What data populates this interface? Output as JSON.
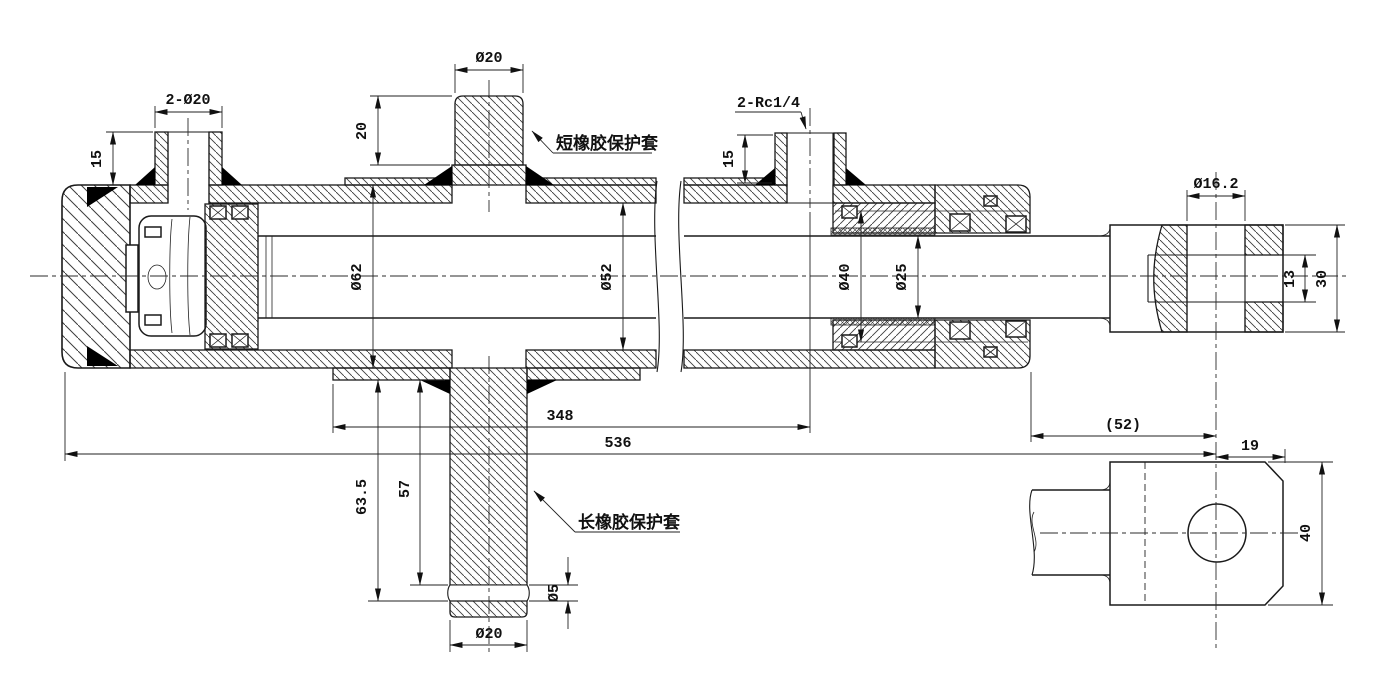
{
  "drawing": {
    "annotations": {
      "short_sleeve": "短橡胶保护套",
      "long_sleeve": "长橡胶保护套"
    },
    "dims": {
      "left_port": "2-Ø20",
      "left_port_h": "15",
      "mid_port": "Ø20",
      "mid_sleeve_h": "20",
      "right_port": "2-Rc1/4",
      "right_port_h": "15",
      "barrel_od": "Ø62",
      "bore": "Ø52",
      "guide_od": "Ø40",
      "rod": "Ø25",
      "len_body": "348",
      "len_total": "536",
      "stroke": "(52)",
      "rod_end": "19",
      "tube_len_total": "63.5",
      "tube_len": "57",
      "groove": "Ø5",
      "bottom_port": "Ø20",
      "pin_hole": "Ø16.2",
      "slot_w": "13",
      "clevis_front_h": "30",
      "clevis_side_h": "40"
    }
  }
}
